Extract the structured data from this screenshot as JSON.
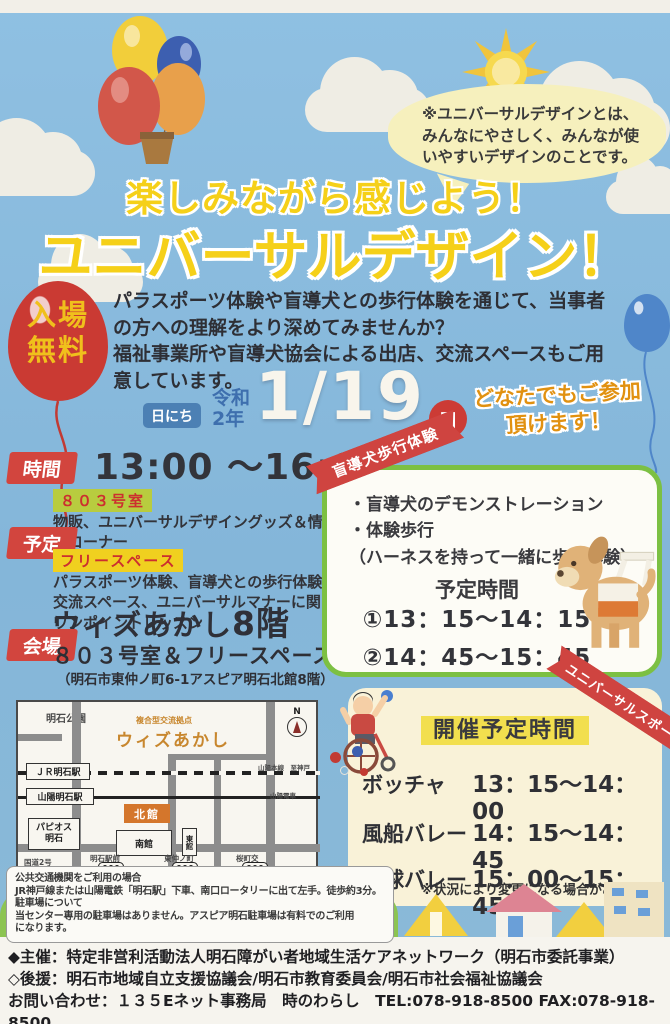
{
  "colors": {
    "sky": "#84b6d9",
    "title_yellow": "#f5d019",
    "accent_red": "#d2453e",
    "card_green": "#7cc043",
    "panel_cream": "#f9f2d8",
    "map_orange": "#c8872e"
  },
  "speech_bubble": {
    "lines": [
      "※ユニバーサルデザインとは、",
      "みんなにやさしく、みんなが使",
      "いやすいデザインのことです。"
    ]
  },
  "title": {
    "line1": "楽しみながら感じよう！",
    "line2": "ユニバーサルデザイン！"
  },
  "admission": {
    "line1": "入場",
    "line2": "無料"
  },
  "intro": {
    "lines": [
      "パラスポーツ体験や盲導犬との歩行体験を通じて、当事者",
      "の方への理解をより深めてみませんか？",
      "福祉事業所や盲導犬協会による出店、交流スペースもご用",
      "意しています。"
    ]
  },
  "date": {
    "label": "日にち",
    "era1": "令和",
    "era2": "2年",
    "value": "1/19",
    "weekday": "日",
    "note1": "どなたでもご参加",
    "note2": "頂けます！"
  },
  "schedule": {
    "time_label": "時間",
    "time_value": "13:00 ～16:00",
    "plan_label": "予定",
    "room_tag": "８０３号室",
    "room_desc1": "物販、ユニバーサルデザイングッズ＆情報展",
    "room_desc2": "示コーナー",
    "free_tag": "フリースペース",
    "free_desc1": "パラスポーツ体験、盲導犬との歩行体験",
    "free_desc2": "交流スペース、ユニバーサルマナーに関する",
    "free_desc3": "ワンポイントレッスン",
    "venue_label": "会場",
    "venue_name": "ウィズあかし",
    "venue_floor": "8階",
    "venue_room": "８０３号室＆フリースペース",
    "venue_addr": "（明石市東仲ノ町6-1アスピア明石北館8階）"
  },
  "dog_card": {
    "ribbon": "盲導犬歩行体験",
    "bullets": [
      "・盲導犬のデモンストレーション",
      "・体験歩行",
      "（ハーネスを持って一緒に歩く体験）"
    ],
    "sched_title": "予定時間",
    "slot1": "①13：15～14：15",
    "slot2": "②14：45～15：45"
  },
  "map": {
    "park": "明石公園",
    "facility_tag": "複合型交流拠点",
    "facility_name": "ウィズあかし",
    "compass": "N",
    "station_jr": "ＪＲ明石駅",
    "station_sanyo": "山陽明石駅",
    "line_main": "山陽本線　至神戸",
    "line_sanyo": "山陽電車",
    "north_bldg": "北館",
    "south_bldg": "南館",
    "east_bldg": "東館",
    "papios1": "パピオス",
    "papios2": "明石",
    "route2": "国道2号",
    "bus1": "明石駅前",
    "bus2": "東仲ノ町",
    "bus3": "桜町交"
  },
  "sports_panel": {
    "ribbon": "ユニバーサルスポーツ",
    "title": "開催予定時間",
    "rows": [
      {
        "name": "ボッチャ",
        "time": "13：15～14：00"
      },
      {
        "name": "風船バレー",
        "time": "14：15～14：45"
      },
      {
        "name": "卓球バレー",
        "time": "15：00～15：45"
      }
    ],
    "note": "※状況により変更になる場合があります"
  },
  "access_box": {
    "lines": [
      "公共交通機関をご利用の場合",
      "JR神戸線または山陽電鉄「明石駅」下車、南口ロータリーに出て左手。徒歩約3分。",
      "駐車場について",
      "当センター専用の駐車場はありません。アスピア明石駐車場は有料でのご利用",
      "になります。"
    ]
  },
  "footer": {
    "line1": "◆主催：特定非営利活動法人明石障がい者地域生活ケアネットワーク（明石市委託事業）",
    "line2": "◇後援：明石市地域自立支援協議会/明石市教育委員会/明石市社会福祉協議会",
    "line3": "お問い合わせ：１３５Eネット事務局　時のわらし　TEL:078-918-8500 FAX:078-918-8500"
  }
}
